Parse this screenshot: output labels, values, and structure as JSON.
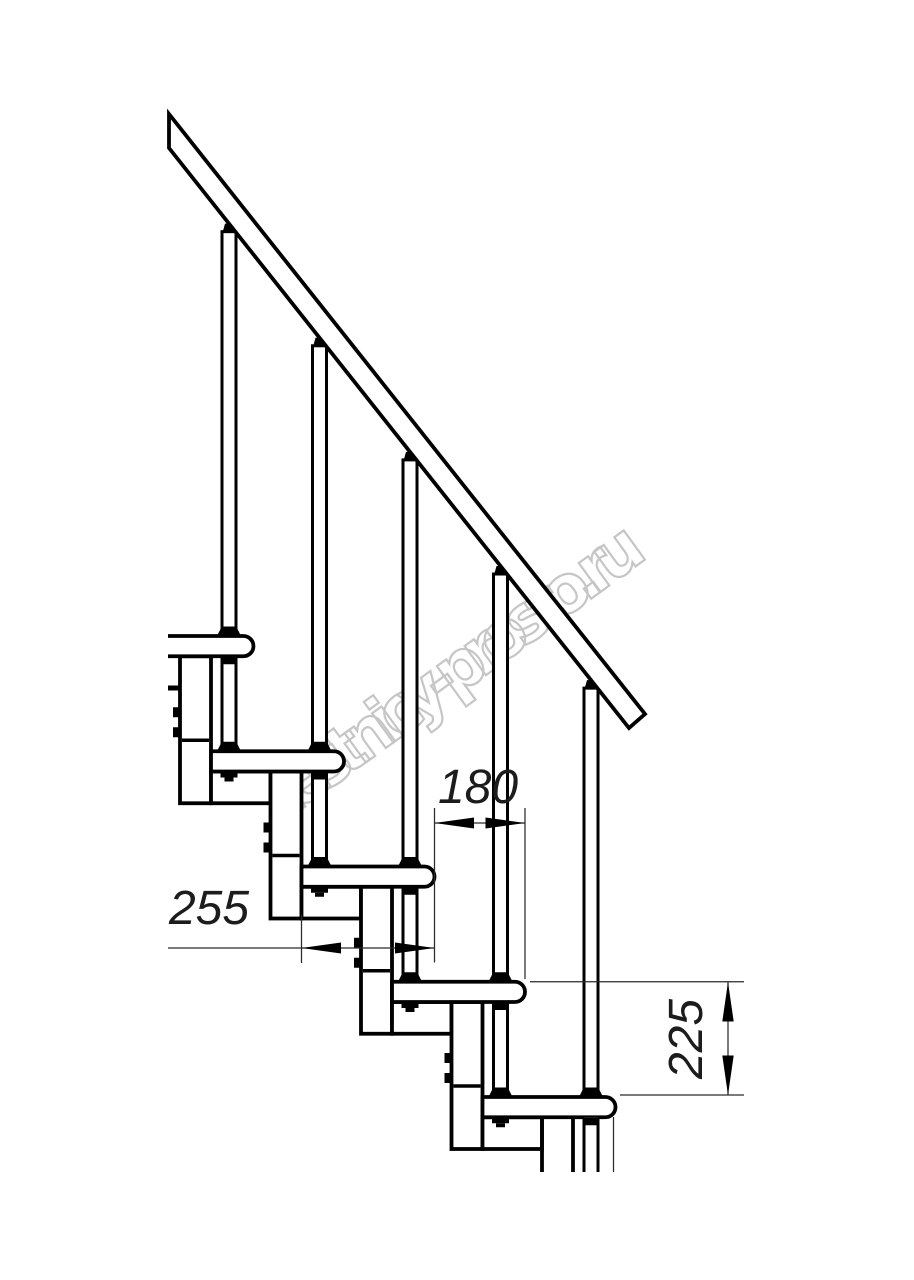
{
  "title": "Modular staircase side-view technical drawing",
  "watermark": {
    "text": "lestnicy-prosto.ru",
    "color": "#c6c6c6"
  },
  "dimensions": {
    "tread_depth": {
      "value": "255",
      "orientation": "horizontal"
    },
    "going": {
      "value": "180",
      "orientation": "horizontal"
    },
    "riser": {
      "value": "225",
      "orientation": "vertical"
    }
  },
  "drawing": {
    "line_color": "#000000",
    "background": "#ffffff",
    "treads_visible": 5,
    "balusters_visible": 5,
    "support_modules_visible": 5,
    "has_handrail": true
  }
}
